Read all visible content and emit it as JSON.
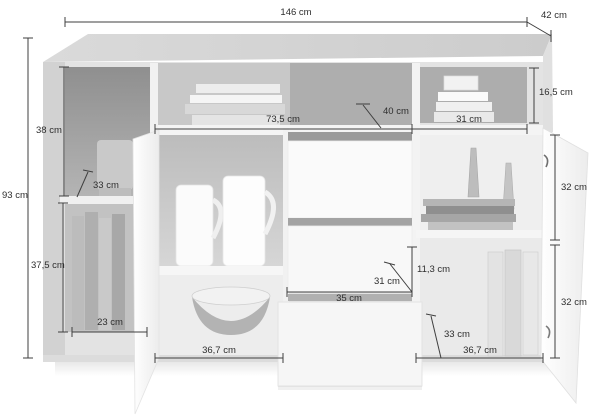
{
  "diagram": {
    "kind": "furniture-dimension-diagram",
    "subject": "sideboard with open doors and drawer"
  },
  "colors": {
    "background": "#ffffff",
    "dimension_line": "#3f3f3f",
    "label_text": "#2e2e2e",
    "cabinet_top": "#d4d4d4",
    "cabinet_frame": "#e6e6e6",
    "interior_dark": "#a0a0a0",
    "door_white": "#fafafa"
  },
  "dimensions": [
    {
      "id": "total-width",
      "label": "146 cm",
      "value": 146,
      "unit": "cm"
    },
    {
      "id": "depth",
      "label": "42 cm",
      "value": 42,
      "unit": "cm"
    },
    {
      "id": "total-height",
      "label": "93 cm",
      "value": 93,
      "unit": "cm"
    },
    {
      "id": "left-upper-compartment-height",
      "label": "38 cm",
      "value": 38,
      "unit": "cm"
    },
    {
      "id": "left-compartment-depth",
      "label": "33 cm",
      "value": 33,
      "unit": "cm"
    },
    {
      "id": "middle-open-shelf-width",
      "label": "73,5 cm",
      "value": 73.5,
      "unit": "cm"
    },
    {
      "id": "middle-shelf-depth",
      "label": "40 cm",
      "value": 40,
      "unit": "cm"
    },
    {
      "id": "right-top-compartment-width",
      "label": "31 cm",
      "value": 31,
      "unit": "cm"
    },
    {
      "id": "right-top-compartment-height",
      "label": "16,5 cm",
      "value": 16.5,
      "unit": "cm"
    },
    {
      "id": "right-upper-compartment-height",
      "label": "32 cm",
      "value": 32,
      "unit": "cm"
    },
    {
      "id": "left-lower-compartment-height",
      "label": "37,5 cm",
      "value": 37.5,
      "unit": "cm"
    },
    {
      "id": "left-lower-compartment-width",
      "label": "23 cm",
      "value": 23,
      "unit": "cm"
    },
    {
      "id": "left-door-width",
      "label": "36,7 cm",
      "value": 36.7,
      "unit": "cm"
    },
    {
      "id": "drawer-width",
      "label": "35 cm",
      "value": 35,
      "unit": "cm"
    },
    {
      "id": "drawer-inner-width",
      "label": "31 cm",
      "value": 31,
      "unit": "cm"
    },
    {
      "id": "drawer-front-height",
      "label": "11,3 cm",
      "value": 11.3,
      "unit": "cm"
    },
    {
      "id": "right-lower-compartment-depth",
      "label": "33 cm",
      "value": 33,
      "unit": "cm"
    },
    {
      "id": "right-door-width",
      "label": "36,7 cm",
      "value": 36.7,
      "unit": "cm"
    },
    {
      "id": "right-lower-compartment-height",
      "label": "32 cm",
      "value": 32,
      "unit": "cm"
    }
  ]
}
